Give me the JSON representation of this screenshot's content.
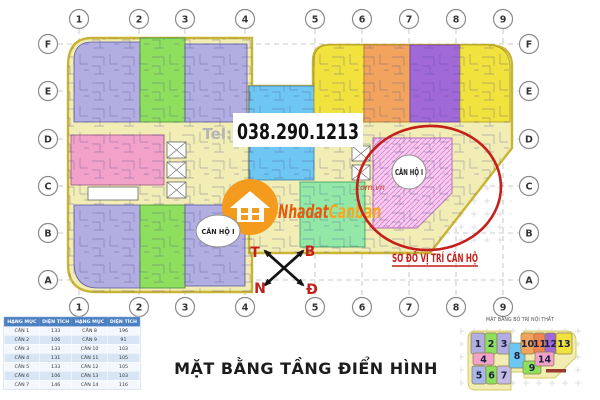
{
  "palette": {
    "lavender": "#b2aee2",
    "green": "#8fdf5f",
    "yellow": "#f2e23e",
    "orange": "#f2a45e",
    "purple": "#a169d8",
    "blue": "#6ec7f2",
    "pink": "#f2a2c8",
    "mint": "#93e8a8",
    "corridor": "#f1edb4",
    "outline": "#c9b435",
    "hatch_pink": "#f5cdef",
    "hatch_line": "#e07ad0",
    "red_accent": "#c41f1a",
    "grid_gray": "#b9b9b9",
    "table_header_bg": "#4a80c2",
    "watermark_orange": "#f49a1c",
    "watermark_text1": "#e8590c",
    "watermark_text2": "#f6a821",
    "unit5_blue": "#a9b6ea",
    "unit7_lavender": "#c3bbe5",
    "unit11_orange": "#ef8352"
  },
  "grid": {
    "columns": [
      "1",
      "2",
      "3",
      "4",
      "5",
      "6",
      "7",
      "8",
      "9"
    ],
    "rows": [
      "F",
      "E",
      "D",
      "C",
      "B",
      "A"
    ]
  },
  "phone": {
    "tel_label": "Tel:",
    "number": "038.290.1213"
  },
  "watermark": {
    "part1": "Nhadat",
    "part2": "Canban",
    "suffix": ".com.vn"
  },
  "labels": {
    "apartment_left": "CĂN HỘ I",
    "apartment_right": "CĂN HỘ I",
    "location_note": "SƠ ĐỒ VỊ TRÍ CĂN HỘ",
    "main_title": "MẶT BẰNG TẦNG ĐIỂN HÌNH",
    "mini_plan_title": "MẶT BẰNG BỐ TRÍ NỘI THẤT"
  },
  "compass": {
    "top_left": "T",
    "top_right": "B",
    "bottom_left": "N",
    "bottom_right": "Đ"
  },
  "area_table": {
    "headers": [
      "HẠNG MỤC",
      "DIỆN TÍCH",
      "HẠNG MỤC",
      "DIỆN TÍCH"
    ],
    "rows": [
      [
        "CĂN 1",
        "133",
        "CĂN 8",
        "196"
      ],
      [
        "CĂN 2",
        "106",
        "CĂN 9",
        "91"
      ],
      [
        "CĂN 3",
        "133",
        "CĂN 10",
        "103"
      ],
      [
        "CĂN 4",
        "131",
        "CĂN 11",
        "105"
      ],
      [
        "CĂN 5",
        "133",
        "CĂN 12",
        "105"
      ],
      [
        "CĂN 6",
        "106",
        "CĂN 13",
        "103"
      ],
      [
        "CĂN 7",
        "146",
        "CĂN 14",
        "116"
      ]
    ]
  },
  "mini_plan": {
    "units": [
      {
        "label": "1",
        "color": "#b2aee2"
      },
      {
        "label": "2",
        "color": "#8fdf5f"
      },
      {
        "label": "3",
        "color": "#b2aee2"
      },
      {
        "label": "4",
        "color": "#f2a2c8"
      },
      {
        "label": "5",
        "color": "#a9b6ea"
      },
      {
        "label": "6",
        "color": "#8fdf5f"
      },
      {
        "label": "7",
        "color": "#c3bbe5"
      },
      {
        "label": "8",
        "color": "#6ec7f2"
      },
      {
        "label": "9",
        "color": "#8fdf5f"
      },
      {
        "label": "10",
        "color": "#f2a45e"
      },
      {
        "label": "11",
        "color": "#ef8352"
      },
      {
        "label": "12",
        "color": "#a169d8"
      },
      {
        "label": "13",
        "color": "#f2e23e"
      },
      {
        "label": "14",
        "color": "#f2a2c8"
      }
    ]
  }
}
